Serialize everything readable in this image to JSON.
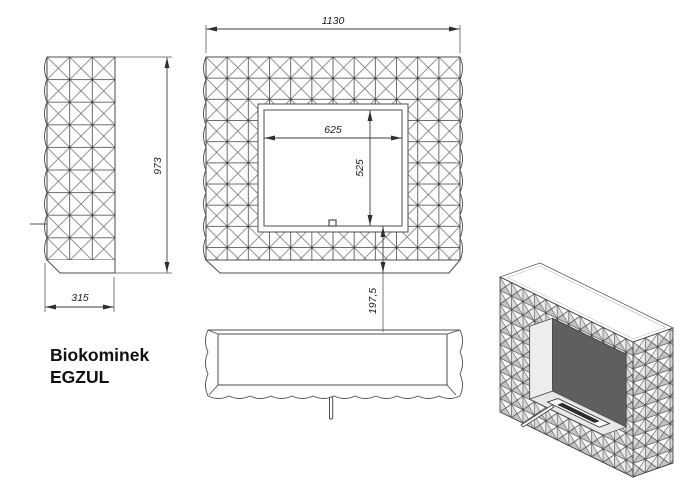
{
  "product": {
    "title_line1": "Biokominek",
    "title_line2": "EGZUL"
  },
  "dimensions": {
    "overall_width": "1130",
    "overall_height": "973",
    "depth": "315",
    "opening_width": "625",
    "opening_height": "525",
    "opening_bottom_offset": "197,5"
  },
  "colors": {
    "background": "#ffffff",
    "line": "#4c4c4c",
    "text": "#1c1c1c",
    "pyramid_shade_dark": "#c4c4c4",
    "pyramid_shade_light": "#d9d9d9",
    "firebox_back_panel": "#5f5f5f",
    "burner_slot": "#2e2e2e"
  }
}
